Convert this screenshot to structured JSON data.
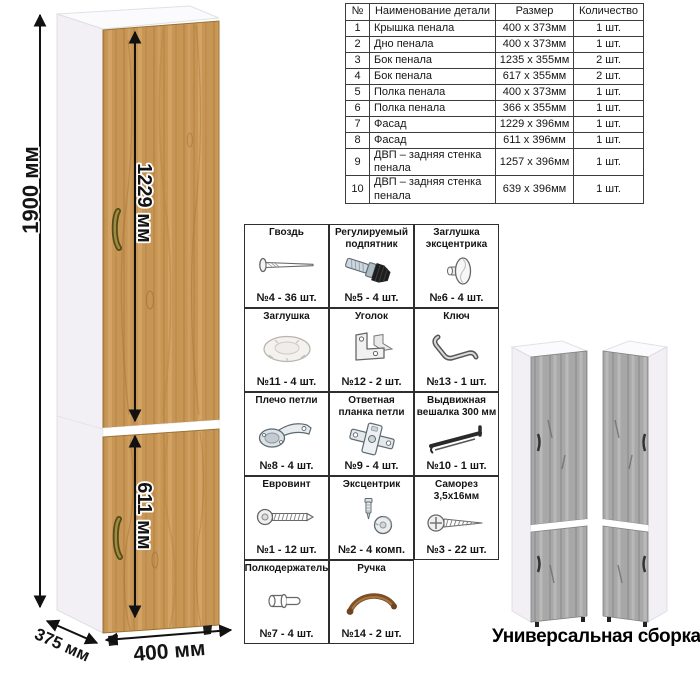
{
  "diagram": {
    "dim_height": "1900 мм",
    "dim_upper_door": "1229 мм",
    "dim_lower_door": "611 мм",
    "dim_width": "400 мм",
    "dim_depth": "375 мм",
    "wood_color": "#c79554",
    "gray_wood_color": "#a8a8a8",
    "handle_color": "#8d7c35"
  },
  "parts_table": {
    "headers": {
      "num": "№",
      "name": "Наименование детали",
      "size": "Размер",
      "qty": "Количество"
    },
    "rows": [
      {
        "num": "1",
        "name": "Крышка пенала",
        "size": "400 х 373мм",
        "qty": "1 шт."
      },
      {
        "num": "2",
        "name": "Дно пенала",
        "size": "400 х 373мм",
        "qty": "1 шт."
      },
      {
        "num": "3",
        "name": "Бок пенала",
        "size": "1235 х 355мм",
        "qty": "2 шт."
      },
      {
        "num": "4",
        "name": "Бок пенала",
        "size": "617 х 355мм",
        "qty": "2 шт."
      },
      {
        "num": "5",
        "name": "Полка пенала",
        "size": "400 х 373мм",
        "qty": "1 шт."
      },
      {
        "num": "6",
        "name": "Полка пенала",
        "size": "366 х 355мм",
        "qty": "1 шт."
      },
      {
        "num": "7",
        "name": "Фасад",
        "size": "1229 х 396мм",
        "qty": "1 шт."
      },
      {
        "num": "8",
        "name": "Фасад",
        "size": "611 х 396мм",
        "qty": "1 шт."
      },
      {
        "num": "9",
        "name": "ДВП – задняя стенка пенала",
        "size": "1257 х 396мм",
        "qty": "1 шт."
      },
      {
        "num": "10",
        "name": "ДВП – задняя стенка пенала",
        "size": "639 х 396мм",
        "qty": "1 шт."
      }
    ]
  },
  "hardware": {
    "items": [
      {
        "title": "Гвоздь",
        "count": "№4 - 36 шт.",
        "icon": "#nail-icon"
      },
      {
        "title": "Регулируемый подпятник",
        "count": "№5 - 4 шт.",
        "icon": "#adjustable-foot-icon"
      },
      {
        "title": "Заглушка эксцентрика",
        "count": "№6 - 4 шт.",
        "icon": "#eccentric-cap-icon"
      },
      {
        "title": "Заглушка",
        "count": "№11 - 4 шт.",
        "icon": "#cap-icon"
      },
      {
        "title": "Уголок",
        "count": "№12 - 2 шт.",
        "icon": "#corner-bracket-icon"
      },
      {
        "title": "Ключ",
        "count": "№13 - 1 шт.",
        "icon": "#key-icon"
      },
      {
        "title": "Плечо петли",
        "count": "№8 - 4 шт.",
        "icon": "#hinge-arm-icon"
      },
      {
        "title": "Ответная планка петли",
        "count": "№9 - 4 шт.",
        "icon": "#hinge-plate-icon"
      },
      {
        "title": "Выдвижная вешалка 300 мм",
        "count": "№10 - 1 шт.",
        "icon": "#pullout-hanger-icon"
      },
      {
        "title": "Евровинт",
        "count": "№1 - 12 шт.",
        "icon": "#euro-screw-icon"
      },
      {
        "title": "Эксцентрик",
        "count": "№2 - 4 комп.",
        "icon": "#eccentric-cam-icon"
      },
      {
        "title": "Саморез 3,5х16мм",
        "count": "№3 - 22 шт.",
        "icon": "#screw-icon"
      },
      {
        "title": "Полкодержатель",
        "count": "№7 - 4 шт.",
        "icon": "#shelf-pin-icon"
      },
      {
        "title": "Ручка",
        "count": "№14 - 2 шт.",
        "icon": "#handle-icon"
      }
    ]
  },
  "footer": {
    "caption": "Универсальная сборка."
  }
}
